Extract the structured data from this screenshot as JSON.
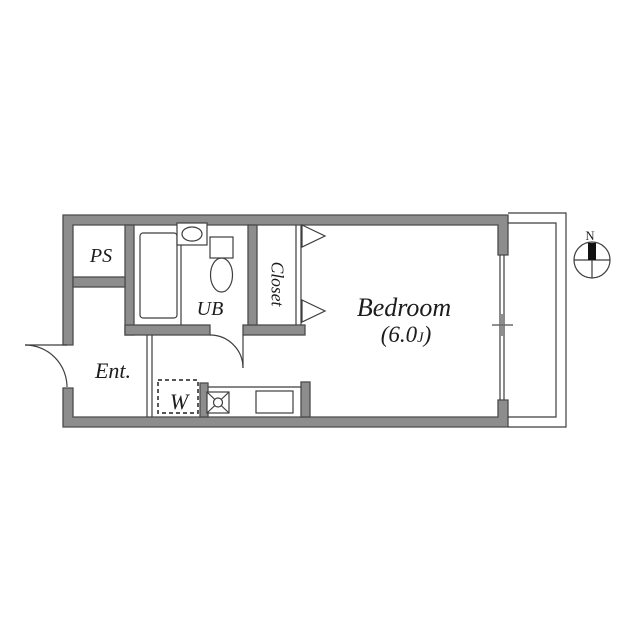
{
  "colors": {
    "wall_fill": "#8d8d8d",
    "wall_stroke": "#4c4c4c",
    "line": "#3e3e3e",
    "text": "#1c1c1c",
    "needle": "#111111"
  },
  "rooms": {
    "ps": {
      "label": "PS"
    },
    "unit_bath": {
      "label": "UB"
    },
    "closet": {
      "label": "Closet"
    },
    "entrance": {
      "label": "Ent."
    },
    "washer_space": {
      "label": "W"
    },
    "bedroom": {
      "label": "Bedroom",
      "size": {
        "open": "(6.0",
        "unit": "J",
        "close": ")"
      }
    }
  },
  "compass": {
    "north": "N"
  },
  "icons": {
    "bathtub": "rounded-rectangle",
    "wash_basin": "ellipse-in-square",
    "toilet": "tank-and-bowl",
    "stove": "square-with-x-and-circle",
    "kitchen_sink": "rectangle",
    "closet_door": "open-triangles",
    "washer_space": "dashed-square",
    "compass": "circle-cross-with-north-needle"
  }
}
